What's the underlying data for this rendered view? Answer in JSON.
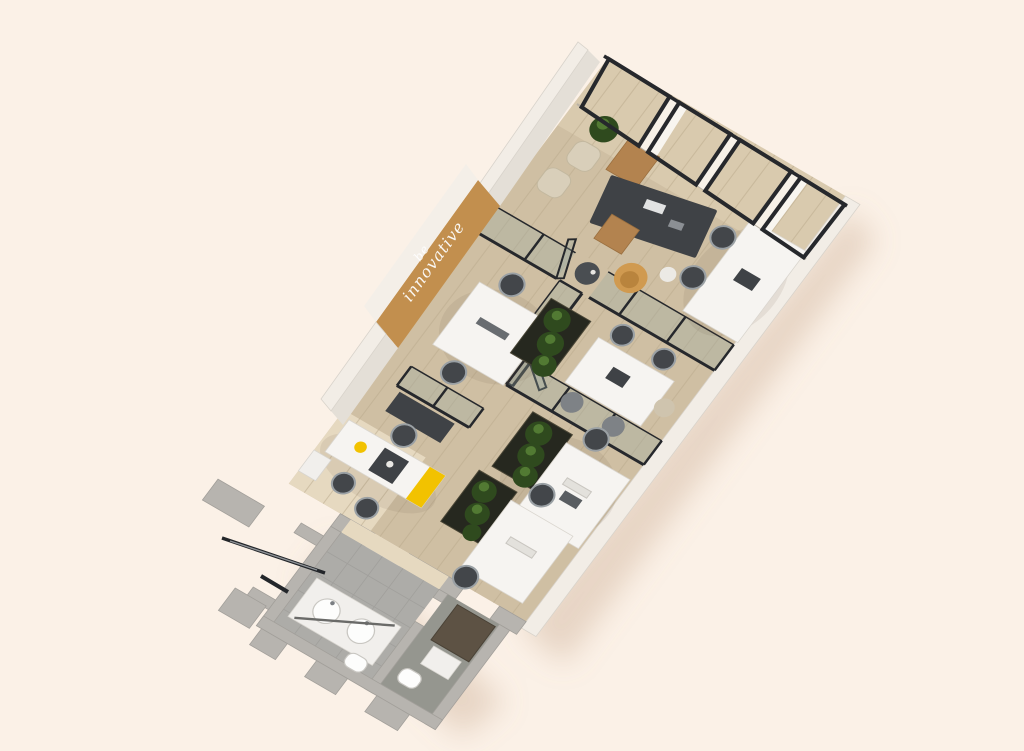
{
  "scene": {
    "description": "3D axonometric render of a long narrow office floor plan on a cream background",
    "wall_art": {
      "line1": "be",
      "line2": "innovative"
    }
  },
  "colors": {
    "background": "#fbf1e7",
    "floor_wood": "#cfbfa3",
    "floor_wood_light": "#e2d4b8",
    "entry_wood": "#e6d9c0",
    "plank_line": "#bcab8e",
    "wall_white": "#f2ede6",
    "wall_edge": "#d8d3cb",
    "wall_face": "#e4dfd7",
    "wall_gray": "#b7b4af",
    "wall_gray_edge": "#a29f9a",
    "tile_light": "#adaca8",
    "tile_dark": "#95968f",
    "tile_line": "#9d9c98",
    "accent_wall": "#c28f4e",
    "accent_wall_top": "#f4efe8",
    "accent_yellow": "#f2c200",
    "frame_black": "#26282c",
    "glass_tint": "rgba(150,168,163,0.30)",
    "desk_white": "#f6f4f1",
    "desk_dark": "#3f4246",
    "chair_dark": "#43464a",
    "chair_ring": "#9aa0a4",
    "chair_beige": "#d9cfba",
    "armchair_tan": "#d09a50",
    "wood_furniture": "#b3834f",
    "plant_dark": "#2f4a1e",
    "plant_light": "#527a33",
    "planter_box": "#26281f",
    "sink_stroke": "#c9c7c2",
    "shadow": "rgba(186,150,120,0.30)",
    "text_white": "#ffffff"
  },
  "objects": {
    "rooms": [
      "executive-office",
      "glass-meeting-room",
      "open-workspace",
      "kitchenette",
      "entrance",
      "washroom",
      "toilet-room"
    ],
    "furniture": [
      "executive-desk",
      "guest-chairs",
      "lounge-armchair",
      "coffee-table",
      "wall-desk",
      "meeting-table",
      "workstation-cluster",
      "planter-divider",
      "kitchen-counter",
      "bar-stools",
      "coffee-machine",
      "fridge",
      "vanity-with-two-sinks",
      "mirror",
      "toilet",
      "potted-plant",
      "glass-partition",
      "window-wall",
      "entrance-glass-door"
    ]
  }
}
